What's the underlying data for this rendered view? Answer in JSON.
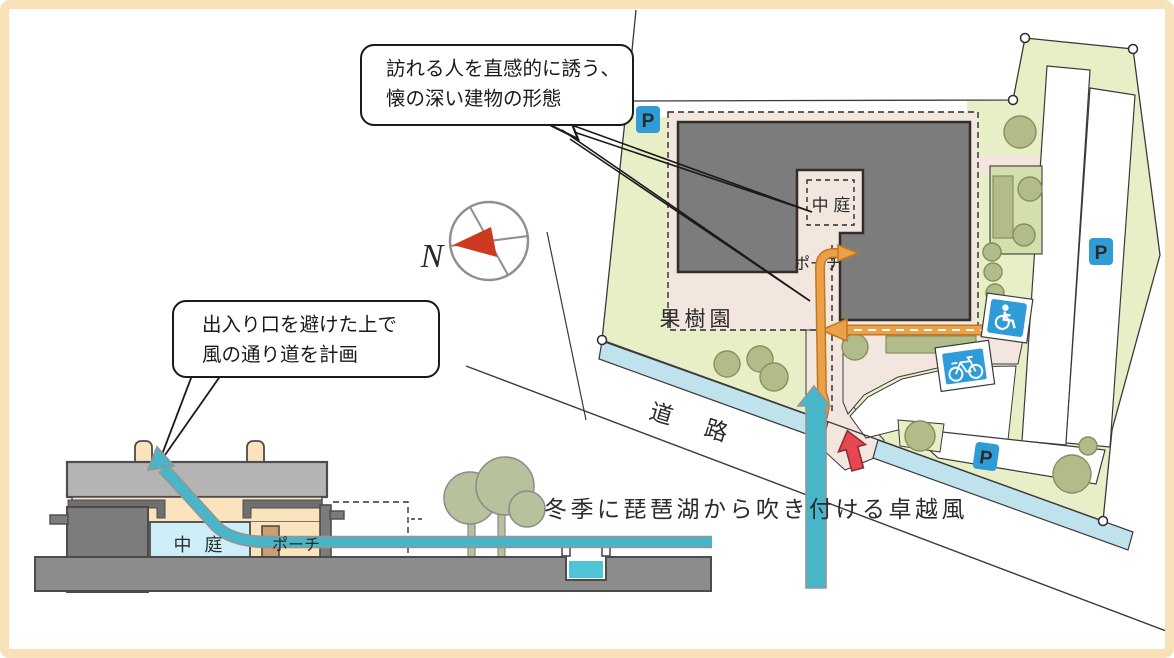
{
  "diagram": {
    "callouts": {
      "building_form": {
        "line1": "訪れる人を直感的に誘う、",
        "line2": "懐の深い建物の形態"
      },
      "wind_path": {
        "line1": "出入り口を避けた上で",
        "line2": "風の通り道を計画"
      }
    },
    "plan": {
      "courtyard_label": "中 庭",
      "porch_label": "ポーチ",
      "orchard_label": "果樹園",
      "road_label": "道 路",
      "parking_label": "P",
      "north_label": "N"
    },
    "section": {
      "courtyard_label": "中 庭",
      "porch_label": "ポーチ"
    },
    "notes": {
      "prevailing_wind": "冬季に琵琶湖から吹き付ける卓越風"
    },
    "colors": {
      "site_green": "#e8eec6",
      "tree_green": "#b2bc8a",
      "plaza_pink": "#f2e6df",
      "building_gray": "#7c7c7c",
      "water_blue": "#bfe2ec",
      "parking_blue": "#2f9cd8",
      "wind_teal": "#47b6c8",
      "approach_orange": "#eda04a",
      "entrance_red": "#e84752",
      "cream_wall": "#fbe3bd",
      "frame_cream": "#f8e0b8"
    }
  }
}
